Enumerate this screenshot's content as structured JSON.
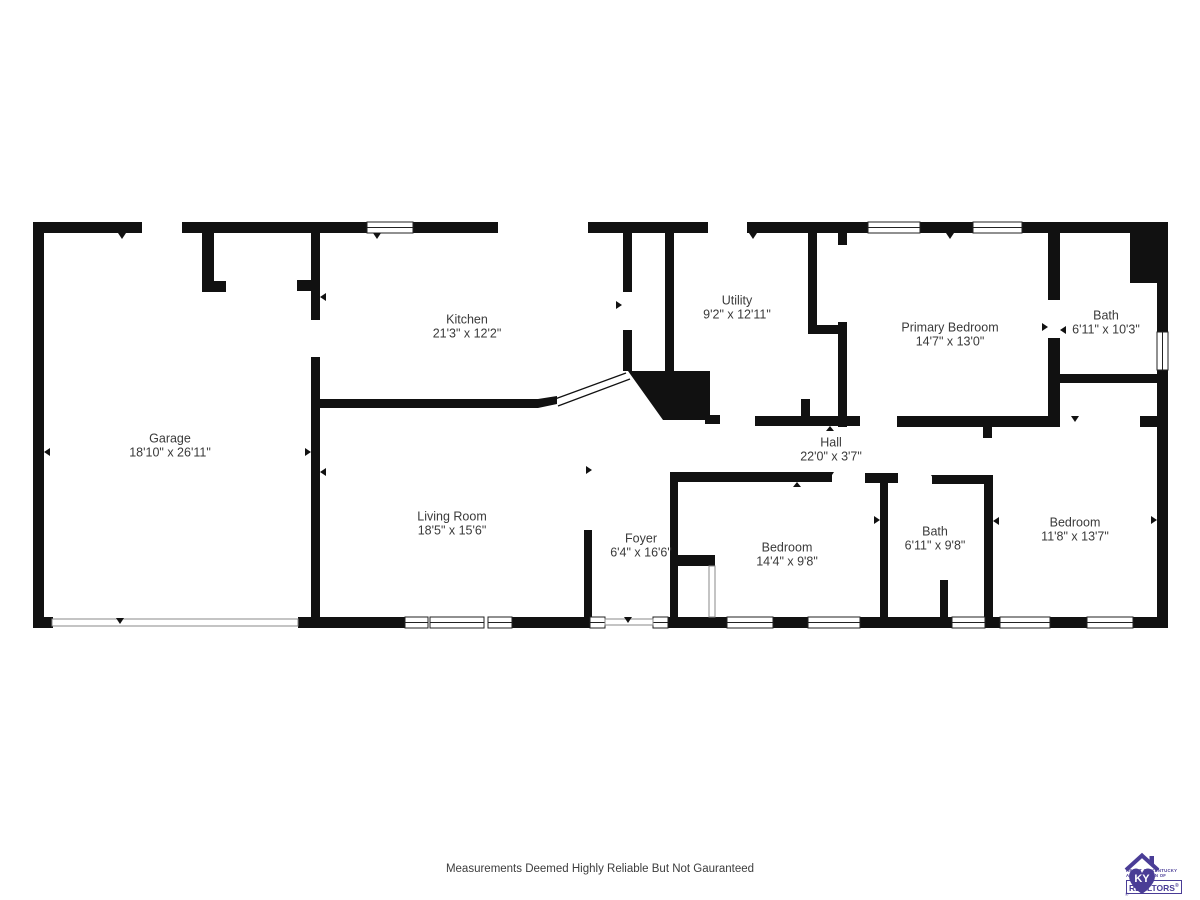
{
  "rooms": [
    {
      "name": "Garage",
      "dims": "18'10\" x 26'11\""
    },
    {
      "name": "Kitchen",
      "dims": "21'3\" x 12'2\""
    },
    {
      "name": "Utility",
      "dims": "9'2\" x 12'11\""
    },
    {
      "name": "Primary Bedroom",
      "dims": "14'7\" x 13'0\""
    },
    {
      "name": "Bath",
      "dims": "6'11\" x 10'3\""
    },
    {
      "name": "Hall",
      "dims": "22'0\" x 3'7\""
    },
    {
      "name": "Living Room",
      "dims": "18'5\" x 15'6\""
    },
    {
      "name": "Foyer",
      "dims": "6'4\" x 16'6\""
    },
    {
      "name": "Bedroom",
      "dims": "14'4\" x 9'8\""
    },
    {
      "name": "Bath",
      "dims": "6'11\" x 9'8\""
    },
    {
      "name": "Bedroom",
      "dims": "11'8\" x 13'7\""
    }
  ],
  "disclaimer": "Measurements Deemed Highly Reliable But Not Gauranteed",
  "logo": {
    "monogram": "KY",
    "line1": "HEART OF KENTUCKY",
    "line2": "ASSOCIATION OF",
    "name": "REALTORS",
    "registered": "®"
  },
  "colors": {
    "ink": "#111111",
    "label": "#3a3a3a",
    "purple": "#4a3d96"
  }
}
